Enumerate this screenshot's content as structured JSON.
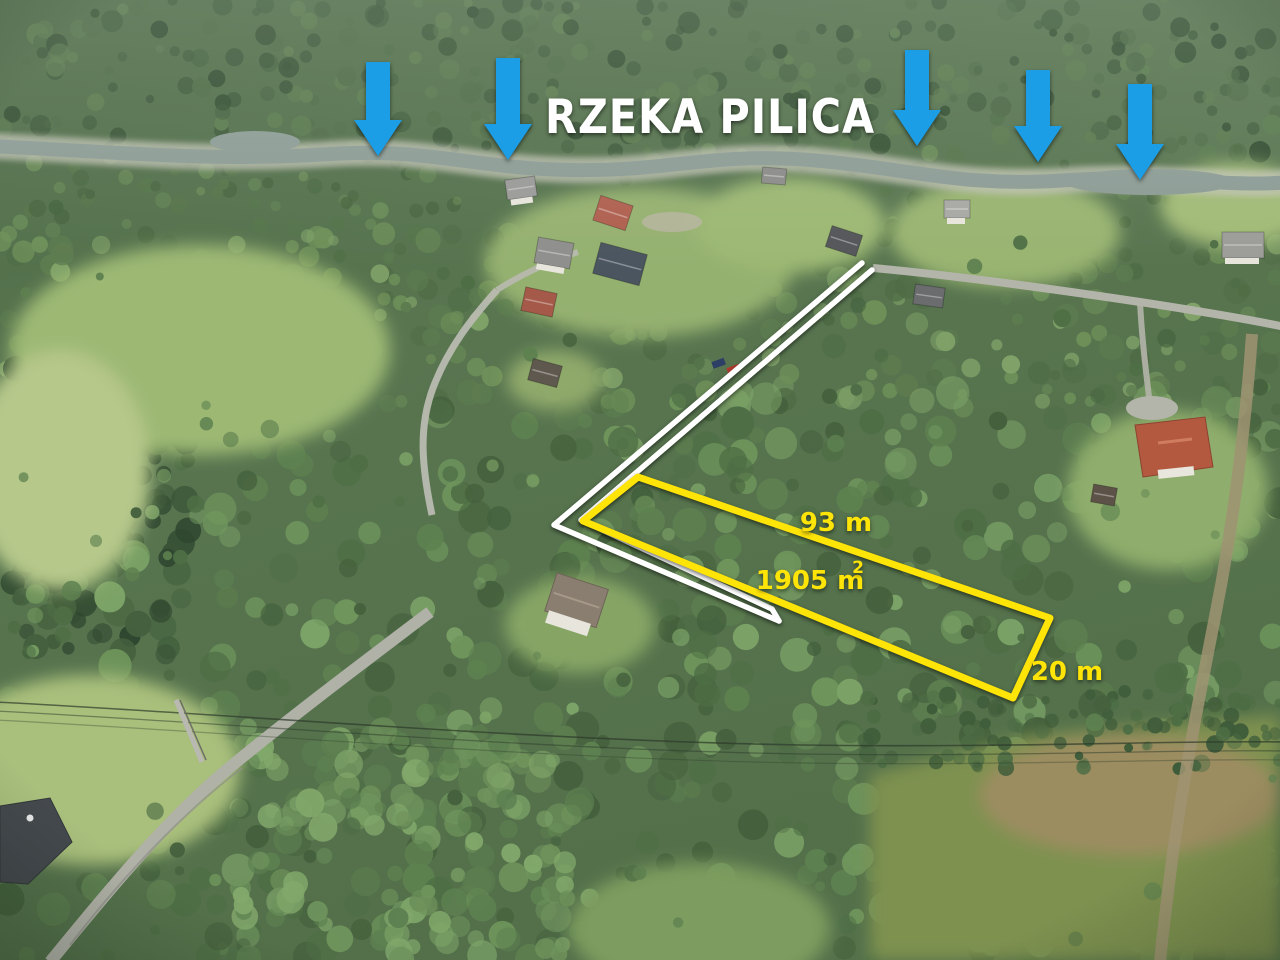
{
  "title": {
    "text": "RZEKA PILICA",
    "color": "#ffffff"
  },
  "annotations": {
    "arrows": {
      "color": "#1b9ee6",
      "items": [
        {
          "x": 378,
          "top": 62,
          "tip": 156
        },
        {
          "x": 508,
          "top": 58,
          "tip": 160
        },
        {
          "x": 917,
          "top": 50,
          "tip": 146
        },
        {
          "x": 1038,
          "top": 70,
          "tip": 162
        },
        {
          "x": 1140,
          "top": 84,
          "tip": 180
        }
      ]
    },
    "plot": {
      "color": "#ffe408",
      "polygon": [
        [
          638,
          477
        ],
        [
          1050,
          618
        ],
        [
          1013,
          698
        ],
        [
          583,
          521
        ]
      ],
      "labels": [
        {
          "text": "93 m",
          "x": 836,
          "y": 531
        },
        {
          "text": "1905 m",
          "sup": "2",
          "x": 810,
          "y": 589
        },
        {
          "text": "20 m",
          "x": 1067,
          "y": 680
        }
      ],
      "length": "93 m",
      "area": "1905 m2",
      "width": "20 m"
    },
    "access_road": {
      "color": "#ffffff",
      "lines": [
        [
          [
            862,
            263
          ],
          [
            554,
            525
          ],
          [
            779,
            621
          ]
        ],
        [
          [
            872,
            270
          ],
          [
            581,
            520
          ],
          [
            772,
            609
          ]
        ]
      ]
    }
  }
}
